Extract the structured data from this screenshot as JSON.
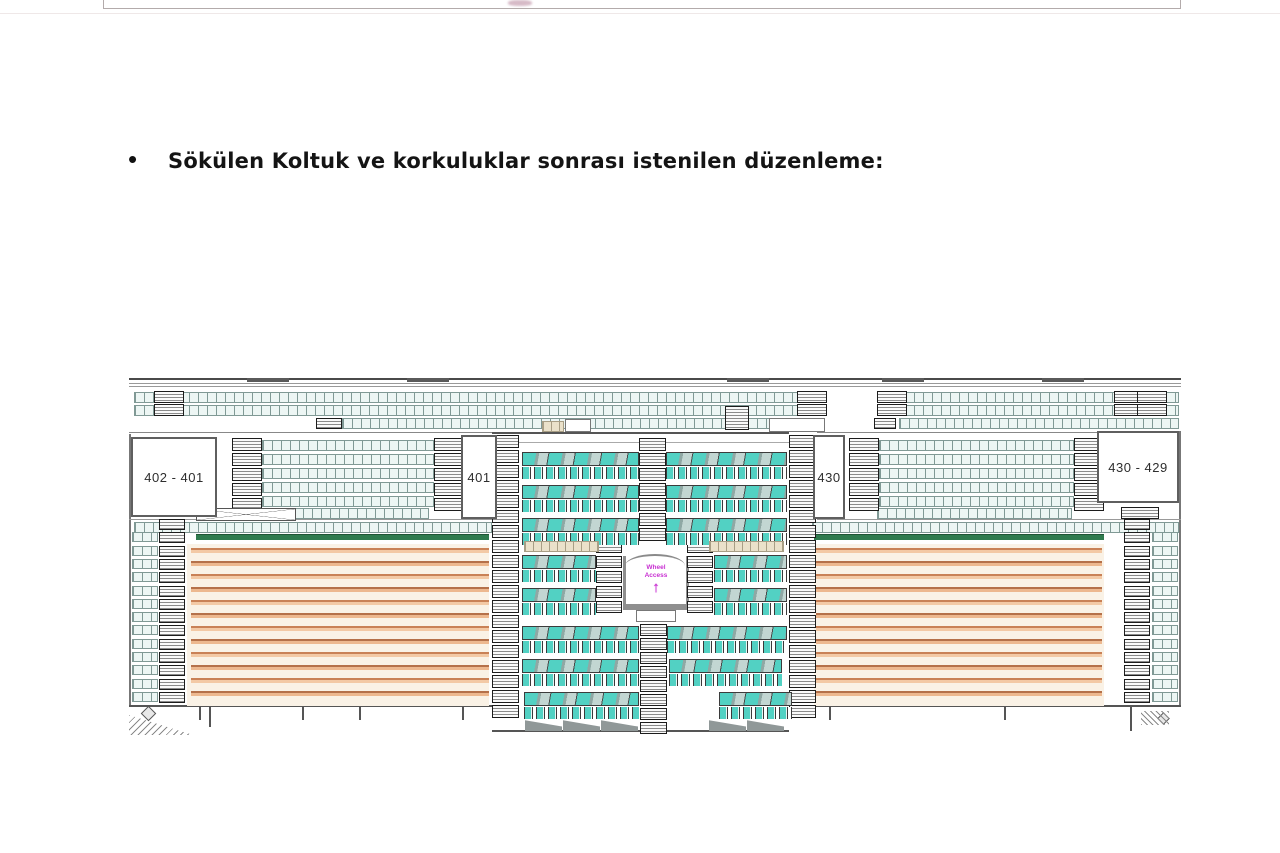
{
  "slide": {
    "bullet": "•",
    "heading": "Sökülen Koltuk ve korkuluklar sonrası istenilen düzenleme:"
  },
  "diagram": {
    "type": "stadium-tribune-seating-plan",
    "section_labels": {
      "far_left": "402 - 401",
      "left": "401",
      "right": "430",
      "far_right": "430 - 429"
    },
    "annotation": {
      "line1": "Wheel",
      "line2": "Access",
      "arrow": "↑"
    },
    "colors": {
      "seat_teal": "#52d1c3",
      "seat_light": "#edf6f4",
      "stripe_dark": "#c0794f",
      "stripe_light": "#f0c19c",
      "stripe_background": "#faf2e6",
      "green_band": "#2f7b4e",
      "annotation_magenta": "#c82fd2"
    }
  }
}
